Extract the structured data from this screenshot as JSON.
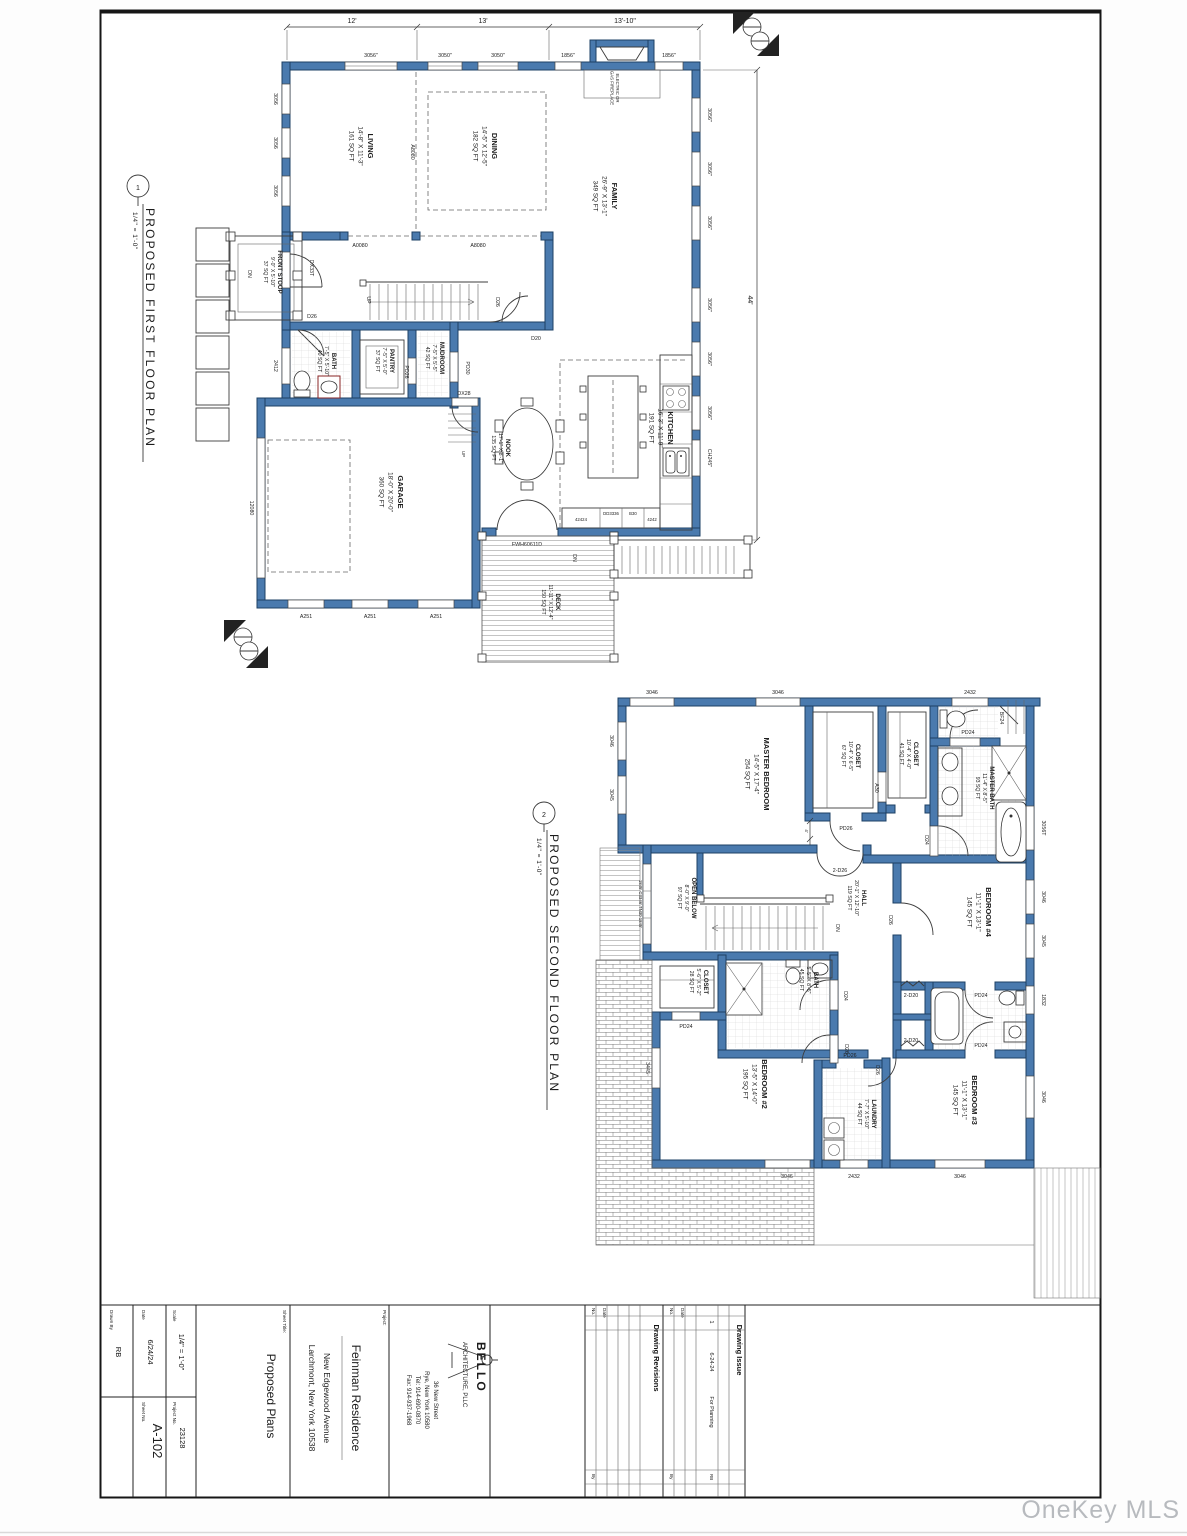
{
  "watermark": "OneKey MLS",
  "plan1": {
    "num": "1",
    "title": "PROPOSED FIRST FLOOR PLAN",
    "scale": "1/4\" = 1'-0\"",
    "rooms": {
      "living": {
        "n": "LIVING",
        "d": "14'-8\" X 11'-3\"",
        "a": "161 SQ FT"
      },
      "dining": {
        "n": "DINING",
        "d": "14'-5\" X 12'-5\"",
        "a": "182 SQ FT"
      },
      "family": {
        "n": "FAMILY",
        "d": "26'-9\" X 13'-1\"",
        "a": "349 SQ FT"
      },
      "kitchen": {
        "n": "KITCHEN",
        "d": "16'-3\" X 11'-9\"",
        "a": "191 SQ FT"
      },
      "nook": {
        "n": "NOOK",
        "d": "17'-1\" X 8'-1\"",
        "a": "135 SQ FT"
      },
      "garage": {
        "n": "GARAGE",
        "d": "18'-0\" X 20'-0\"",
        "a": "360 SQ FT"
      },
      "deck": {
        "n": "DECK",
        "d": "11'-11\" X 12'-4\"",
        "a": "150 SQ FT"
      },
      "stoop": {
        "n": "FRONT STOOP",
        "d": "9'-0\" X 5'-10\"",
        "a": "37 SQ FT"
      },
      "bath": {
        "n": "BATH",
        "d": "7'-5\" X 5'-10\"",
        "a": "40 SQ FT"
      },
      "pantry": {
        "n": "PANTRY",
        "d": "7'-5\" X 5'-0\"",
        "a": "37 SQ FT"
      },
      "mudroom": {
        "n": "MUDROOM",
        "d": "7'-5\" X 5'-5\"",
        "a": "42 SQ FT"
      }
    },
    "dims": {
      "w1": "12'",
      "w2": "13'",
      "w3": "13'-10\"",
      "h": "44'"
    },
    "notes": {
      "fp1": "ELECTRIC OR",
      "fp2": "GAS FIREPLACE",
      "up1": "UP",
      "up2": "UP",
      "dn_stoop": "DN",
      "dn_deck": "DN"
    },
    "tags": {
      "t1": "3056\"",
      "t2": "3050\"",
      "t3": "3050\"",
      "t4": "1856\"",
      "t5": "1856\"",
      "l1": "3056",
      "l2": "3056",
      "l3": "3056",
      "l4": "2412",
      "r1": "3056\"",
      "r2": "3056\"",
      "r3": "3056\"",
      "r4": "3056\"",
      "r5": "3056\"",
      "r6": "3056\"",
      "kwin": "CH245\"",
      "g1": "A251",
      "g2": "A251",
      "g3": "A251",
      "gdoor": "12080",
      "fwh": "FWH60611D",
      "frontdoor": "DX33T",
      "a_up1": "A8080",
      "a_lo1": "A0080",
      "a_lo2": "A8080",
      "d_bath": "D26",
      "d_stair": "D26",
      "d_d20": "D20",
      "d_pantry": "PD26",
      "d_mud": "PD30",
      "d_dx28": "DX28",
      "cab1": "42424",
      "cab2": "DD3336",
      "cab3": "B30",
      "cab4": "4242"
    }
  },
  "plan2": {
    "num": "2",
    "title": "PROPOSED SECOND FLOOR PLAN",
    "scale": "1/4\" = 1'-0\"",
    "rooms": {
      "master": {
        "n": "MASTER BEDROOM",
        "d": "14'-5\" X 17'-4\"",
        "a": "254 SQ FT"
      },
      "wic1": {
        "n": "CLOSET",
        "d": "10'-4\" X 6'-5\"",
        "a": "67 SQ FT"
      },
      "wic2": {
        "n": "CLOSET",
        "d": "10'-4\" X 4'-0\"",
        "a": "41 SQ FT"
      },
      "mbath": {
        "n": "MASTER BATH",
        "d": "11'-4\" X 8'-5\"",
        "a": "93 SQ FT"
      },
      "open": {
        "n": "OPEN BELOW",
        "d": "8'-0\" X 9'-0\"",
        "a": "97 SQ FT"
      },
      "hall": {
        "n": "HALL",
        "d": "20'-1\" X 12'-10\"",
        "a": "119 SQ FT"
      },
      "bed4": {
        "n": "BEDROOM #4",
        "d": "11'-1\" X 13'-1\"",
        "a": "145 SQ FT"
      },
      "cl2f": {
        "n": "CLOSET",
        "d": "5'-6\" X 5'-2\"",
        "a": "28 SQ FT"
      },
      "hbath": {
        "n": "BATH",
        "d": "5'-5\" X 8'-5\"",
        "a": "45 SQ FT"
      },
      "bed2": {
        "n": "BEDROOM #2",
        "d": "13'-5\" X 14'-0\"",
        "a": "195 SQ FT"
      },
      "laundry": {
        "n": "LAUNDRY",
        "d": "7'-7\" X 5'-10\"",
        "a": "44 SQ FT"
      },
      "bed3": {
        "n": "BEDROOM #3",
        "d": "11'-1\" X 13'-1\"",
        "a": "145 SQ FT"
      }
    },
    "notes": {
      "dn": "DN"
    },
    "tags": {
      "top1": "3046",
      "top2": "3046",
      "top3": "2432",
      "left1": "3046",
      "left2": "3045",
      "stairwin": "1845' C3346' TN30 1845'",
      "r1": "3056T",
      "r2": "3046",
      "r3": "3045",
      "r4": "1832",
      "r5": "3046",
      "b1": "3046",
      "b2": "2432",
      "b3": "3046",
      "w3445": "3445",
      "dd": "2-D26",
      "pd_cl": "PD26",
      "a30": "A30",
      "pd_wc": "PD24",
      "bf": "BF24",
      "d_mb": "D24",
      "d_b4": "D26",
      "pd_cl2": "PD24",
      "d_hb": "D24",
      "d_b2": "D26",
      "d_b3": "D26",
      "pd_la": "PD26",
      "bif1": "2-D20",
      "bif2": "2-D20",
      "jj1": "PD24",
      "jj2": "PD24",
      "dim4": "4'"
    }
  },
  "tb": {
    "labels": {
      "drawn_by": "Drawn By",
      "date": "Date",
      "scale": "Scale",
      "sheet_no": "Sheet No.",
      "project_no": "Project No.",
      "sheet_title": "Sheet Title:",
      "project": "Project:",
      "revisions": "Drawing Revisions",
      "issue": "Drawing Issue",
      "no": "No.",
      "date2": "Date",
      "by": "By",
      "by2": "By",
      "no2": "No.",
      "date3": "Date"
    },
    "values": {
      "drawn_by": "RB",
      "date": "6/24/24",
      "scale": "1/4\" = 1'-0\"",
      "sheet_no": "A-102",
      "project_no": "23128",
      "sheet_title": "Proposed Plans",
      "project_name": "Feinman Residence",
      "addr1": "New Edgewood Avenue",
      "addr2": "Larchmont, New York 10538",
      "issue_no": "1",
      "issue_date": "6-24-24",
      "issue_desc": "For Planning",
      "issue_by": "RB"
    },
    "arch": {
      "name": "BELLO",
      "firm": "ARCHITECTURE, PLLC",
      "addr1": "36 New Street",
      "addr2": "Rye, New York 10580",
      "tel": "Tel:  914-690-0870",
      "fax": "Fax: 914-937-1968"
    }
  }
}
